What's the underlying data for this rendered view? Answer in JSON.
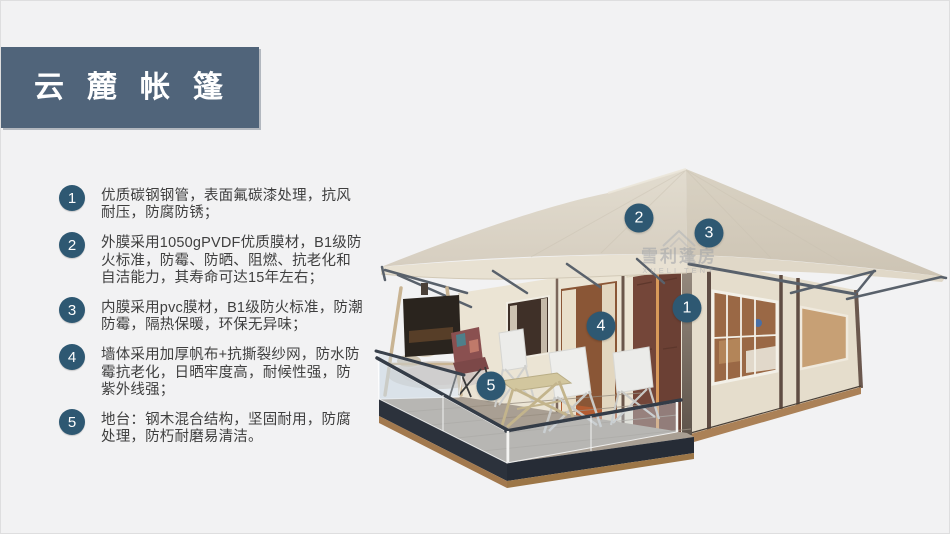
{
  "header": {
    "title": "云麓帐篷"
  },
  "features": [
    {
      "num": "1",
      "text": "优质碳钢钢管，表面氟碳漆处理，抗风耐压，防腐防锈；"
    },
    {
      "num": "2",
      "text": "外膜采用1050gPVDF优质膜材，B1级防火标准，防霉、防晒、阻燃、抗老化和自洁能力，其寿命可达15年左右；"
    },
    {
      "num": "3",
      "text": "内膜采用pvc膜材，B1级防火标准，防潮防霉，隔热保暖，环保无异味；"
    },
    {
      "num": "4",
      "text": "墙体采用加厚帆布+抗撕裂纱网，防水防霉抗老化，日晒牢度高，耐候性强，防紫外线强；"
    },
    {
      "num": "5",
      "text": "地台：钢木混合结构，坚固耐用，防腐处理，防朽耐磨易清洁。"
    }
  ],
  "callouts": [
    {
      "label": "1"
    },
    {
      "label": "2"
    },
    {
      "label": "3"
    },
    {
      "label": "4"
    },
    {
      "label": "5"
    }
  ],
  "watermark": {
    "cn": "雪利蓬房",
    "en": "XUELI TENT"
  },
  "colors": {
    "accent": "#50647a",
    "badge": "#2e5872",
    "background": "#f2f2f3"
  }
}
